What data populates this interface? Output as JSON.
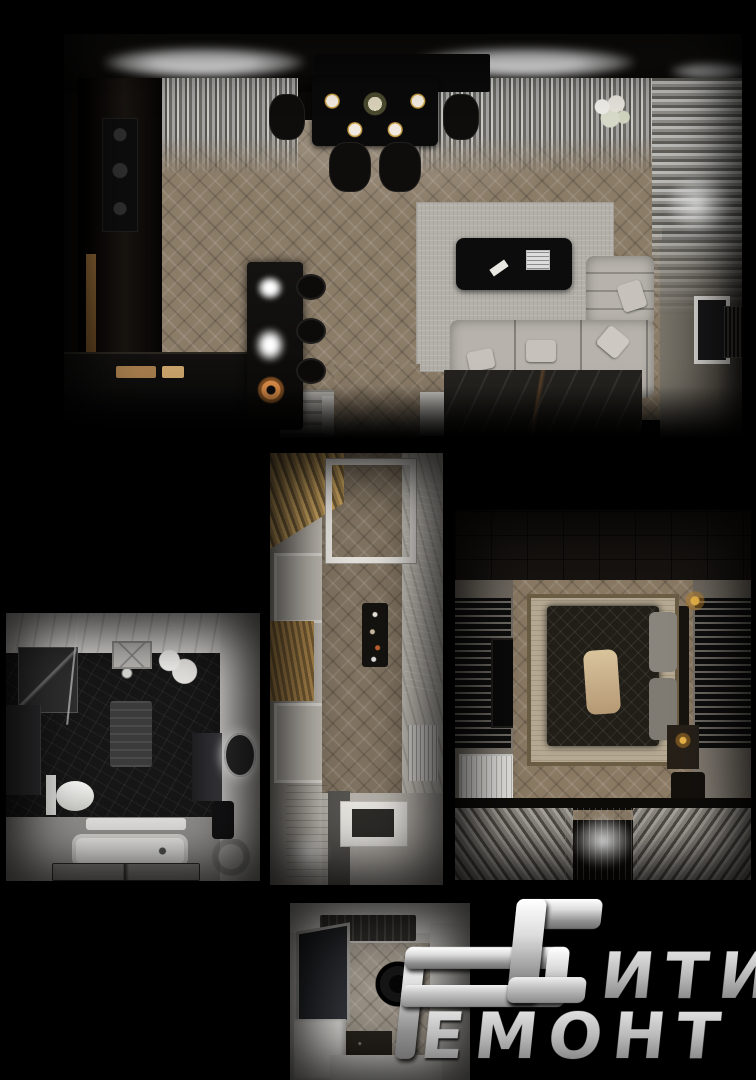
{
  "canvas": {
    "background": "#000000",
    "width": 756,
    "height": 1080
  },
  "palette": {
    "logo_silver_light": "#f2f2f2",
    "logo_silver_dark": "#6f6f6f",
    "wood_floor": "#8b7c68",
    "gold_slat": "#c9a35f",
    "copper_accent": "#c47a3a",
    "sofa_gray": "#b7b3ac",
    "marble_white": "#d7d5d2",
    "marble_black": "#161616"
  },
  "panels": [
    {
      "id": "living-room-top-view"
    },
    {
      "id": "bathroom-top-view"
    },
    {
      "id": "hallway-top-view"
    },
    {
      "id": "bedroom-top-view"
    },
    {
      "id": "entry-hall-top-view"
    }
  ],
  "logo": {
    "brand": "Сити Ремонт",
    "monogram": "РС",
    "word1_suffix": "ити",
    "word2_suffix": "емонт"
  }
}
